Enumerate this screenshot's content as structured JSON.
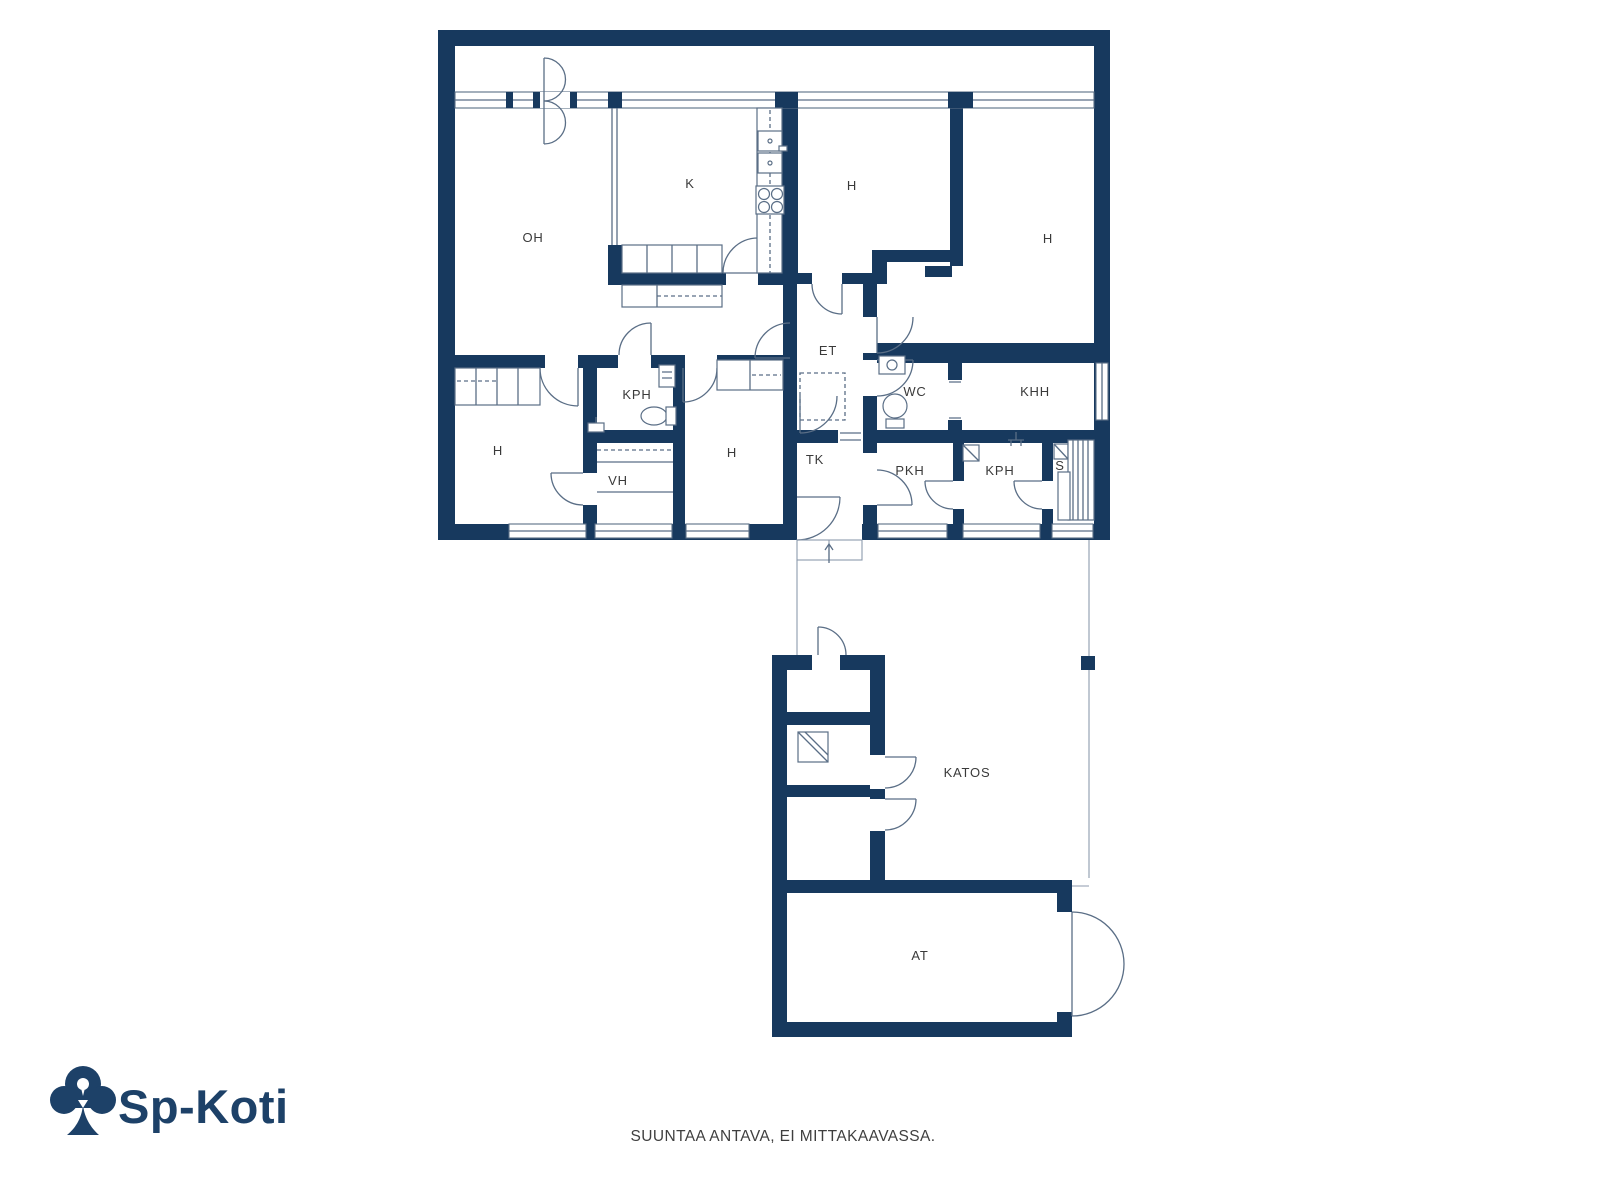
{
  "rooms": {
    "living_room": "OH",
    "kitchen": "K",
    "bedroom_top_middle": "H",
    "bedroom_top_right": "H",
    "entry_hall": "ET",
    "toilet": "WC",
    "utility_room": "KHH",
    "bathroom_1": "KPH",
    "bedroom_left": "H",
    "bedroom_middle": "H",
    "walk_in_closet": "VH",
    "vestibule": "TK",
    "dressing_room": "PKH",
    "bathroom_2": "KPH",
    "sauna": "S",
    "canopy": "KATOS",
    "garage": "AT"
  },
  "logo": {
    "brand": "Sp-Koti"
  },
  "footer": {
    "disclaimer": "SUUNTAA ANTAVA, EI MITTAKAAVASSA."
  },
  "colors": {
    "wall": "#17395E",
    "thin_line": "#5A6E86",
    "brand": "#1D4168",
    "label": "#3A3A3A",
    "background": "#FFFFFF"
  }
}
